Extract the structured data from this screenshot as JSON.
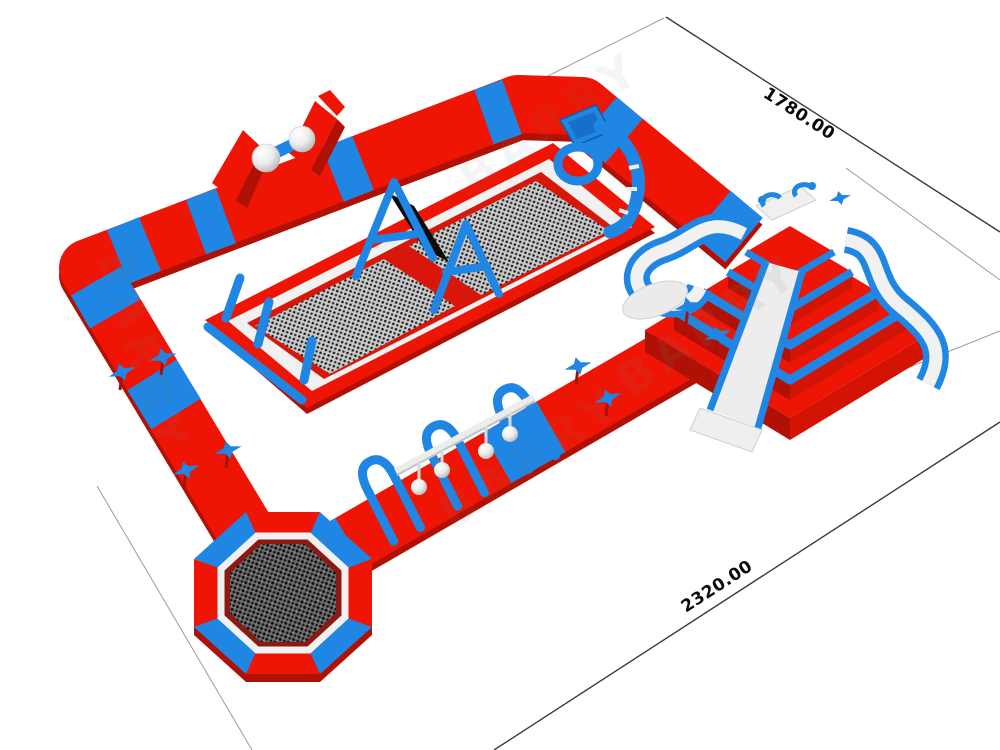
{
  "canvas": {
    "width": 1000,
    "height": 750,
    "background": "#ffffff"
  },
  "annotations": {
    "length_dim": "2320.00",
    "depth_dim": "1780.00"
  },
  "watermark": {
    "text": "BARRY"
  },
  "parts": [
    "loop-floating-track",
    "ball-walk-obstacle",
    "net-trampoline-arena",
    "ring-climb-frame",
    "hanging-balls-obstacle",
    "octagon-trampoline",
    "pyramid-slide-tower",
    "star-decorations"
  ],
  "colors": {
    "red": "#ee1505",
    "red_mid": "#d31405",
    "red_dark": "#b01104",
    "blue": "#1f86e3",
    "blue_mid": "#1670c9",
    "blue_dark": "#0d5cab",
    "part_white": "#f1f1f1",
    "part_gray": "#d0d0d0",
    "mesh_bg": "#cccccc",
    "mesh_dot": "#191919",
    "mesh2_bg": "#6e6e6e",
    "mesh2_dot": "#0d0d0d",
    "dim_line": "#3a3a3a",
    "ext_line": "#9b9b9b",
    "label_ink": "#0a0a0a",
    "watermark_ink": "#7d7d7d",
    "band_black": "#0b0b0b"
  }
}
